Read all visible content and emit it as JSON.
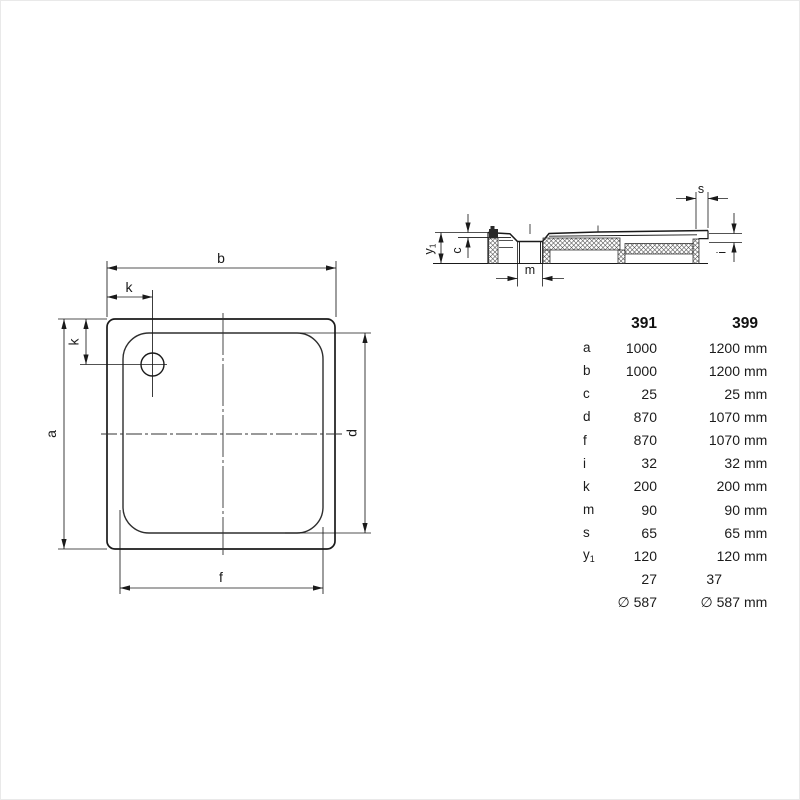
{
  "colors": {
    "line": "#1a1a1a",
    "text": "#1b1b1b"
  },
  "drawing": {
    "plan": {
      "b": "b",
      "k_top": "k",
      "k_left": "k",
      "a": "a",
      "d": "d",
      "f": "f"
    },
    "section": {
      "s": "s",
      "y1_base": "y",
      "y1_sub": "1",
      "c": "c",
      "m": "m",
      "i": "i"
    }
  },
  "table": {
    "col_headers": [
      "391",
      "399"
    ],
    "rows": [
      {
        "label": "a",
        "v391": "1000",
        "v399": "1200",
        "unit": "mm"
      },
      {
        "label": "b",
        "v391": "1000",
        "v399": "1200",
        "unit": "mm"
      },
      {
        "label": "c",
        "v391": "25",
        "v399": "25",
        "unit": "mm"
      },
      {
        "label": "d",
        "v391": "870",
        "v399": "1070",
        "unit": "mm"
      },
      {
        "label": "f",
        "v391": "870",
        "v399": "1070",
        "unit": "mm"
      },
      {
        "label": "i",
        "v391": "32",
        "v399": "32",
        "unit": "mm"
      },
      {
        "label": "k",
        "v391": "200",
        "v399": "200",
        "unit": "mm"
      },
      {
        "label": "m",
        "v391": "90",
        "v399": "90",
        "unit": "mm"
      },
      {
        "label": "s",
        "v391": "65",
        "v399": "65",
        "unit": "mm"
      },
      {
        "label_base": "y",
        "label_sub": "1",
        "v391": "120",
        "v399": "120",
        "unit": "mm"
      },
      {
        "label": "",
        "v391": "27",
        "v399": "37",
        "unit": ""
      },
      {
        "label": "",
        "v391": "∅ 587",
        "v399": "∅ 587",
        "unit": "mm"
      }
    ]
  }
}
